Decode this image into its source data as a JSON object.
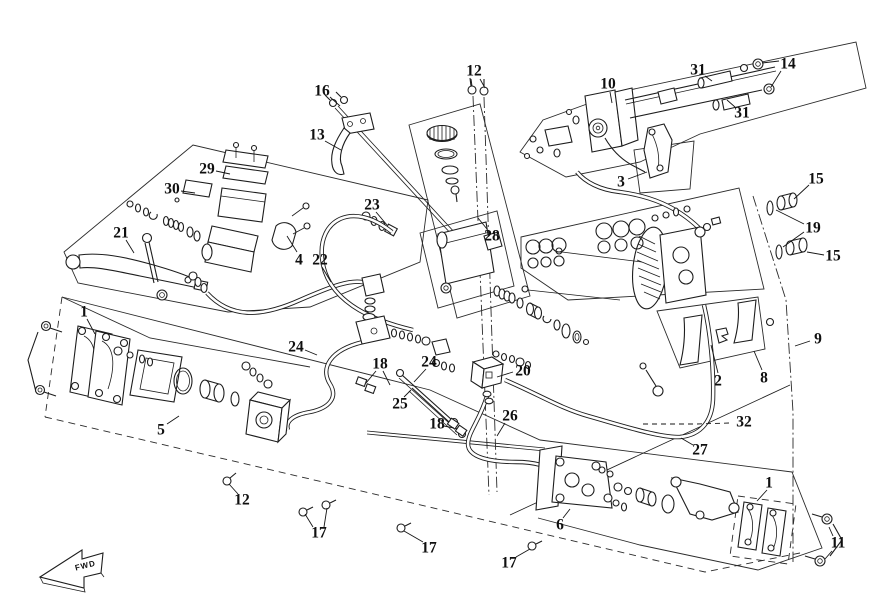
{
  "diagram": {
    "figure_type": "exploded-parts-diagram",
    "subject": "Brake system exploded view (master cylinders, hoses, calipers)",
    "drawing_style": "monochrome line art",
    "background_color": "#ffffff",
    "line_color": "#1d1d1d",
    "fwd_marker": {
      "label": "FWD",
      "x": 92,
      "y": 565
    },
    "callouts": [
      {
        "label": "16",
        "x": 322,
        "y": 91,
        "leaders": [
          [
            [
              330,
              97
            ],
            [
              340,
              106
            ]
          ]
        ]
      },
      {
        "label": "13",
        "x": 317,
        "y": 135,
        "leaders": [
          [
            [
              325,
              141
            ],
            [
              341,
              150
            ]
          ]
        ]
      },
      {
        "label": "12",
        "x": 474,
        "y": 71,
        "leaders": [
          [
            [
              471,
              79
            ],
            [
              472,
              86
            ]
          ],
          [
            [
              480,
              79
            ],
            [
              485,
              88
            ]
          ]
        ]
      },
      {
        "label": "10",
        "x": 608,
        "y": 84,
        "leaders": [
          [
            [
              610,
              92
            ],
            [
              612,
              103
            ]
          ]
        ]
      },
      {
        "label": "31",
        "x": 698,
        "y": 70,
        "leaders": [
          [
            [
              705,
              76
            ],
            [
              712,
              81
            ]
          ]
        ]
      },
      {
        "label": "14",
        "x": 788,
        "y": 64,
        "leaders": [
          [
            [
              779,
              61
            ],
            [
              762,
              63
            ]
          ],
          [
            [
              781,
              71
            ],
            [
              771,
              87
            ]
          ]
        ]
      },
      {
        "label": "31",
        "x": 742,
        "y": 113,
        "leaders": [
          [
            [
              735,
              107
            ],
            [
              727,
              100
            ]
          ]
        ]
      },
      {
        "label": "3",
        "x": 621,
        "y": 182,
        "leaders": [
          [
            [
              628,
              179
            ],
            [
              647,
              172
            ]
          ]
        ]
      },
      {
        "label": "29",
        "x": 207,
        "y": 169,
        "leaders": [
          [
            [
              216,
              171
            ],
            [
              230,
              174
            ]
          ]
        ]
      },
      {
        "label": "30",
        "x": 172,
        "y": 189,
        "leaders": [
          [
            [
              181,
              191
            ],
            [
              195,
              193
            ]
          ]
        ]
      },
      {
        "label": "21",
        "x": 121,
        "y": 233,
        "leaders": [
          [
            [
              126,
              240
            ],
            [
              134,
              253
            ]
          ]
        ]
      },
      {
        "label": "4",
        "x": 299,
        "y": 260,
        "leaders": [
          [
            [
              297,
              252
            ],
            [
              287,
              236
            ]
          ]
        ]
      },
      {
        "label": "22",
        "x": 320,
        "y": 260,
        "leaders": [
          [
            [
              322,
              267
            ],
            [
              331,
              282
            ]
          ]
        ]
      },
      {
        "label": "23",
        "x": 372,
        "y": 205,
        "leaders": [
          [
            [
              376,
              212
            ],
            [
              387,
              225
            ]
          ]
        ]
      },
      {
        "label": "28",
        "x": 492,
        "y": 236,
        "leaders": [
          [
            [
              487,
              229
            ],
            [
              478,
              218
            ]
          ]
        ]
      },
      {
        "label": "15",
        "x": 816,
        "y": 179,
        "leaders": [
          [
            [
              809,
              185
            ],
            [
              794,
              199
            ]
          ]
        ]
      },
      {
        "label": "19",
        "x": 813,
        "y": 228,
        "leaders": [
          [
            [
              804,
              224
            ],
            [
              776,
              210
            ]
          ],
          [
            [
              804,
              232
            ],
            [
              783,
              247
            ]
          ]
        ]
      },
      {
        "label": "15",
        "x": 833,
        "y": 256,
        "leaders": [
          [
            [
              824,
              255
            ],
            [
              807,
              252
            ]
          ]
        ]
      },
      {
        "label": "9",
        "x": 818,
        "y": 339,
        "leaders": [
          [
            [
              810,
              341
            ],
            [
              795,
              346
            ]
          ]
        ]
      },
      {
        "label": "2",
        "x": 718,
        "y": 381,
        "leaders": [
          [
            [
              718,
              373
            ],
            [
              711,
              345
            ]
          ]
        ]
      },
      {
        "label": "8",
        "x": 764,
        "y": 378,
        "leaders": [
          [
            [
              762,
              370
            ],
            [
              754,
              351
            ]
          ]
        ]
      },
      {
        "label": "1",
        "x": 84,
        "y": 312,
        "leaders": [
          [
            [
              87,
              319
            ],
            [
              95,
              334
            ]
          ]
        ]
      },
      {
        "label": "24",
        "x": 296,
        "y": 347,
        "leaders": [
          [
            [
              305,
              350
            ],
            [
              317,
              355
            ]
          ]
        ]
      },
      {
        "label": "18",
        "x": 380,
        "y": 364,
        "leaders": [
          [
            [
              376,
              371
            ],
            [
              366,
              383
            ]
          ],
          [
            [
              383,
              371
            ],
            [
              390,
              385
            ]
          ]
        ]
      },
      {
        "label": "24",
        "x": 429,
        "y": 362,
        "leaders": [
          [
            [
              426,
              369
            ],
            [
              414,
              382
            ]
          ]
        ]
      },
      {
        "label": "20",
        "x": 523,
        "y": 371,
        "leaders": [
          [
            [
              513,
              372
            ],
            [
              497,
              377
            ]
          ]
        ]
      },
      {
        "label": "25",
        "x": 400,
        "y": 404,
        "leaders": [
          [
            [
              404,
              397
            ],
            [
              411,
              390
            ]
          ]
        ]
      },
      {
        "label": "26",
        "x": 510,
        "y": 416,
        "leaders": [
          [
            [
              505,
              423
            ],
            [
              497,
              436
            ]
          ]
        ]
      },
      {
        "label": "5",
        "x": 161,
        "y": 430,
        "leaders": [
          [
            [
              167,
              424
            ],
            [
              179,
              416
            ]
          ]
        ]
      },
      {
        "label": "18",
        "x": 437,
        "y": 424,
        "leaders": [
          [
            [
              444,
              426
            ],
            [
              454,
              428
            ]
          ]
        ]
      },
      {
        "label": "12",
        "x": 242,
        "y": 500,
        "leaders": [
          [
            [
              238,
              494
            ],
            [
              229,
              484
            ]
          ]
        ]
      },
      {
        "label": "17",
        "x": 319,
        "y": 533,
        "leaders": [
          [
            [
              313,
              527
            ],
            [
              305,
              514
            ]
          ],
          [
            [
              324,
              527
            ],
            [
              327,
              508
            ]
          ]
        ]
      },
      {
        "label": "17",
        "x": 429,
        "y": 548,
        "leaders": [
          [
            [
              423,
              542
            ],
            [
              404,
              531
            ]
          ]
        ]
      },
      {
        "label": "17",
        "x": 509,
        "y": 563,
        "leaders": [
          [
            [
              516,
              557
            ],
            [
              530,
              549
            ]
          ]
        ]
      },
      {
        "label": "6",
        "x": 560,
        "y": 525,
        "leaders": [
          [
            [
              563,
              518
            ],
            [
              570,
              509
            ]
          ]
        ]
      },
      {
        "label": "1",
        "x": 769,
        "y": 483,
        "leaders": [
          [
            [
              767,
              490
            ],
            [
              757,
              501
            ]
          ]
        ]
      },
      {
        "label": "27",
        "x": 700,
        "y": 450,
        "leaders": [
          [
            [
              693,
              445
            ],
            [
              681,
              438
            ]
          ]
        ]
      },
      {
        "label": "32",
        "x": 744,
        "y": 422,
        "dashed": true,
        "leaders": [
          [
            [
              729,
              423
            ],
            [
              697,
              424
            ],
            [
              640,
              424
            ]
          ]
        ]
      },
      {
        "label": "11",
        "x": 838,
        "y": 543,
        "leaders": [
          [
            [
              833,
              536
            ],
            [
              829,
              527
            ]
          ],
          [
            [
              832,
              551
            ],
            [
              825,
              559
            ]
          ]
        ]
      }
    ]
  }
}
